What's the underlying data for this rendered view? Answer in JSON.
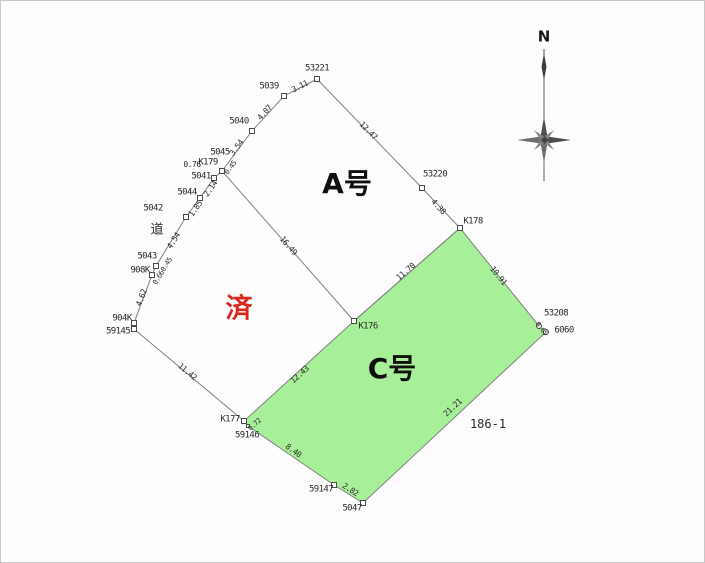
{
  "map": {
    "parcel_a_label": "A号",
    "parcel_c_label": "C号",
    "status_stamp": "済",
    "lot_number": "186-1",
    "road_label": "道",
    "compass_north": "N"
  },
  "colors": {
    "parcel_c_fill": "#a8ef99",
    "stamp_red": "#d9291f",
    "boundary_gray": "#828282"
  },
  "labels_pos": {
    "parcel_a": {
      "x": 346,
      "y": 183
    },
    "parcel_c": {
      "x": 391,
      "y": 368
    },
    "stamp": {
      "x": 238,
      "y": 308
    },
    "lot": {
      "x": 487,
      "y": 423
    },
    "road": {
      "x": 156,
      "y": 229
    },
    "compass_n": {
      "x": 543,
      "y": 36
    }
  },
  "points": [
    {
      "label": "53221",
      "x": 316,
      "y": 78,
      "lx": 316,
      "ly": 68
    },
    {
      "label": "5039",
      "x": 283,
      "y": 95,
      "lx": 268,
      "ly": 86
    },
    {
      "label": "5040",
      "x": 251,
      "y": 130,
      "lx": 238,
      "ly": 121
    },
    {
      "label": "5045",
      "x": 221,
      "y": 170,
      "lx": 219,
      "ly": 152
    },
    {
      "label": "K179",
      "x": 217,
      "y": 172,
      "lx": 207,
      "ly": 162,
      "shape": "none"
    },
    {
      "label": "5041",
      "x": 213,
      "y": 177,
      "lx": 200,
      "ly": 176
    },
    {
      "label": "5044",
      "x": 199,
      "y": 197,
      "lx": 186,
      "ly": 192
    },
    {
      "label": "5042",
      "x": 185,
      "y": 216,
      "lx": 152,
      "ly": 208
    },
    {
      "label": "5043",
      "x": 155,
      "y": 265,
      "lx": 146,
      "ly": 256
    },
    {
      "label": "908K",
      "x": 151,
      "y": 274,
      "lx": 139,
      "ly": 270
    },
    {
      "label": "904K",
      "x": 133,
      "y": 322,
      "lx": 121,
      "ly": 318
    },
    {
      "label": "59145",
      "x": 133,
      "y": 328,
      "lx": 117,
      "ly": 331
    },
    {
      "label": "K177",
      "x": 243,
      "y": 420,
      "lx": 229,
      "ly": 419
    },
    {
      "label": "59146",
      "x": 247,
      "y": 425,
      "lx": 246,
      "ly": 435,
      "shape": "tiny"
    },
    {
      "label": "59147",
      "x": 333,
      "y": 484,
      "lx": 320,
      "ly": 489
    },
    {
      "label": "5047",
      "x": 362,
      "y": 502,
      "lx": 351,
      "ly": 508
    },
    {
      "label": "K176",
      "x": 353,
      "y": 320,
      "lx": 367,
      "ly": 326
    },
    {
      "label": "K178",
      "x": 459,
      "y": 227,
      "lx": 472,
      "ly": 221
    },
    {
      "label": "53220",
      "x": 421,
      "y": 187,
      "lx": 434,
      "ly": 174
    },
    {
      "label": "53208",
      "x": 538,
      "y": 325,
      "lx": 555,
      "ly": 313,
      "shape": "circle"
    },
    {
      "label": "6060",
      "x": 545,
      "y": 331,
      "lx": 563,
      "ly": 330,
      "shape": "circle"
    }
  ],
  "measurements": [
    {
      "value": "3.11",
      "x": 299,
      "y": 86,
      "angle": -27
    },
    {
      "value": "12.47",
      "x": 367,
      "y": 130,
      "angle": 46
    },
    {
      "value": "4.07",
      "x": 264,
      "y": 112,
      "angle": -48
    },
    {
      "value": "3.54",
      "x": 236,
      "y": 147,
      "angle": -53
    },
    {
      "value": "0.45",
      "x": 230,
      "y": 167,
      "angle": -53,
      "small": true
    },
    {
      "value": "0.76",
      "x": 191,
      "y": 164,
      "angle": 0
    },
    {
      "value": "2.14",
      "x": 210,
      "y": 188,
      "angle": -55
    },
    {
      "value": "1.85",
      "x": 195,
      "y": 208,
      "angle": -55
    },
    {
      "value": "4.54",
      "x": 173,
      "y": 240,
      "angle": -58
    },
    {
      "value": "0.45",
      "x": 166,
      "y": 264,
      "angle": -58,
      "small": true
    },
    {
      "value": "0.66",
      "x": 158,
      "y": 277,
      "angle": -58,
      "small": true
    },
    {
      "value": "4.62",
      "x": 141,
      "y": 297,
      "angle": -69
    },
    {
      "value": "11.42",
      "x": 186,
      "y": 371,
      "angle": 40
    },
    {
      "value": "16.49",
      "x": 287,
      "y": 245,
      "angle": 49
    },
    {
      "value": "12.43",
      "x": 299,
      "y": 374,
      "angle": -42
    },
    {
      "value": "0.72",
      "x": 254,
      "y": 424,
      "angle": -42,
      "small": true
    },
    {
      "value": "8.40",
      "x": 292,
      "y": 450,
      "angle": 35
    },
    {
      "value": "2.82",
      "x": 349,
      "y": 489,
      "angle": 33
    },
    {
      "value": "11.70",
      "x": 405,
      "y": 271,
      "angle": -41
    },
    {
      "value": "4.38",
      "x": 437,
      "y": 206,
      "angle": 47
    },
    {
      "value": "10.91",
      "x": 497,
      "y": 275,
      "angle": 51
    },
    {
      "value": "0.65",
      "x": 540,
      "y": 328,
      "angle": 51,
      "small": true
    },
    {
      "value": "21.21",
      "x": 452,
      "y": 407,
      "angle": -43
    }
  ]
}
